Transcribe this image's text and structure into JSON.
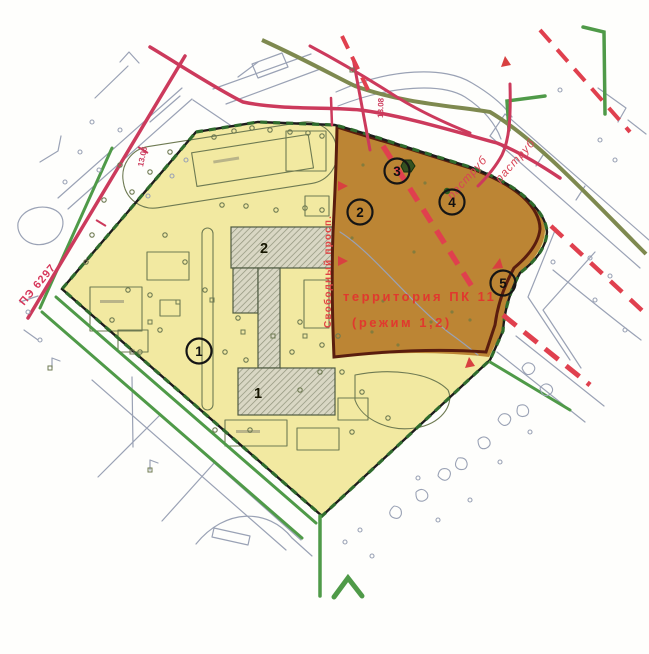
{
  "map": {
    "labels": {
      "territory_line1": "территория ПК 11",
      "territory_line2": "(режим 1,2)",
      "street": "Свободный просп.",
      "rastrub_upper": "раструб",
      "rastrub_lower": "раструб",
      "line_number": "ПЭ 6297",
      "elevation_nw": "13.06",
      "elevation_n": "13.08"
    },
    "markers": [
      {
        "number": "1"
      },
      {
        "number": "2"
      },
      {
        "number": "3"
      },
      {
        "number": "4"
      },
      {
        "number": "5"
      }
    ],
    "building_numbers": [
      {
        "number": "1"
      },
      {
        "number": "2"
      }
    ],
    "colors": {
      "site_fill": "#f2e9a1",
      "territory_fill": "#bc8534",
      "territory_border": "#5a1d0e",
      "boundary_green": "#2f6b2d",
      "utility_red": "#cc3a5c",
      "dashed_red": "#e0404e",
      "green_line": "#4f9a48",
      "label_red": "#e0392e"
    }
  }
}
